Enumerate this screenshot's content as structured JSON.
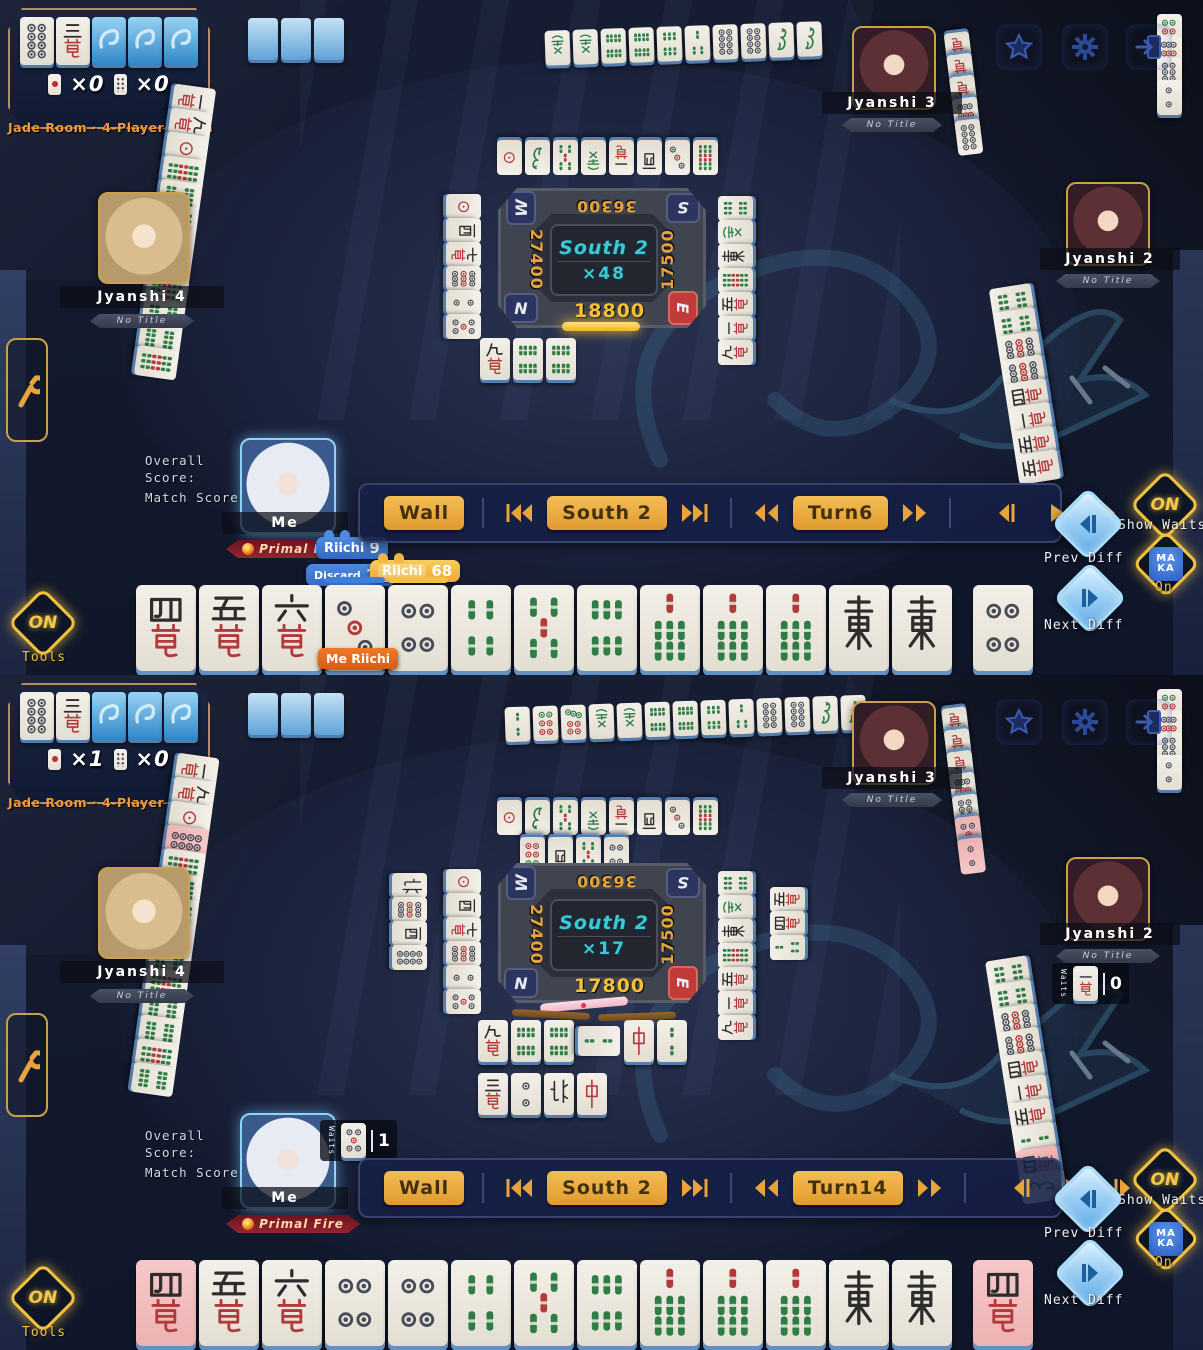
{
  "panels": [
    {
      "dora": {
        "tiles": [
          "8p",
          "3m",
          "back",
          "back",
          "back"
        ],
        "counter1_value": "×0",
        "counter2_value": "×0"
      },
      "room_label": "Jade Room · 4-Player South",
      "players": {
        "j3": {
          "name": "Jyanshi 3",
          "title": "No Title"
        },
        "j4": {
          "name": "Jyanshi 4",
          "title": "No Title"
        },
        "j2": {
          "name": "Jyanshi 2",
          "title": "No Title"
        },
        "me": {
          "name": "Me",
          "title": "Primal Fire"
        }
      },
      "me_panel": {
        "overall_label": "Overall Score:",
        "match_label": "Match Score:",
        "overall_grade": "S-",
        "match_grade": "S-",
        "grade_sub": "MAKA"
      },
      "center": {
        "seat_tl": "W",
        "seat_tr": "S",
        "seat_bl": "N",
        "seat_br": "E",
        "score_top": "36300",
        "score_left": "27400",
        "score_right": "17500",
        "score_bottom": "18800",
        "round": "South 2",
        "multiplier": "×48"
      },
      "replay": {
        "wall": "Wall",
        "round": "South 2",
        "turn": "Turn6"
      },
      "side": {
        "show_waits_state": "ON",
        "show_waits_label": "Show Waits",
        "prev_label": "Prev Diff",
        "next_label": "Next Diff",
        "maka_top": "MA",
        "maka_bottom": "KA",
        "maka_label": "On",
        "tools_state": "ON",
        "tools_label": "Tools"
      },
      "hints": {
        "riichi_label": "Riichi",
        "riichi_value": "9",
        "discard_label": "Discard",
        "discard_value": "14",
        "best_label": "Riichi",
        "best_value": "68",
        "me_riichi": "Me Riichi"
      },
      "hand": {
        "tiles": [
          "4m",
          "5m",
          "6m",
          "3p",
          "4p",
          "4s",
          "5s",
          "6s",
          "7s",
          "7s",
          "7s",
          "E",
          "E"
        ],
        "drawn": "4p"
      },
      "walls": {
        "top": [
          "back",
          "back",
          "back"
        ]
      },
      "rivers": {
        "j3_row": [
          "F",
          "F",
          "8s",
          "8s",
          "6s",
          "3s",
          "8p",
          "8p",
          "1s",
          "1s"
        ],
        "j3_col": [
          "7m",
          "7m",
          "6m",
          "9p",
          "8p"
        ],
        "j4_col": [
          "1m",
          "9m",
          "1p",
          "9s",
          "8s",
          "9s",
          "8s",
          "8s",
          "9s",
          "8s",
          "8s",
          "9s"
        ],
        "j2_row": [
          "6p",
          "9p",
          "8p",
          "2p"
        ],
        "j2_col": [
          "6s",
          "6s",
          "9p",
          "9p",
          "4m",
          "1m",
          "5m",
          "5m"
        ],
        "pond_top": [
          "1p",
          "1s",
          "5s",
          "F",
          "1m",
          "W",
          "3p",
          "9s"
        ],
        "pond_left": [
          "1p",
          "W",
          "7m",
          "9p",
          "2p",
          "5p"
        ],
        "pond_right": [
          "6s",
          "F",
          "E",
          "9s",
          "5m",
          "1m",
          "9m"
        ],
        "pond_me": [
          "9m",
          "8s",
          "8s"
        ]
      }
    },
    {
      "dora": {
        "tiles": [
          "8p",
          "3m",
          "back",
          "back",
          "back"
        ],
        "counter1_value": "×1",
        "counter2_value": "×0"
      },
      "room_label": "Jade Room · 4-Player South",
      "players": {
        "j3": {
          "name": "Jyanshi 3",
          "title": "No Title"
        },
        "j4": {
          "name": "Jyanshi 4",
          "title": "No Title"
        },
        "j2": {
          "name": "Jyanshi 2",
          "title": "No Title"
        },
        "me": {
          "name": "Me",
          "title": "Primal Fire"
        }
      },
      "me_panel": {
        "overall_label": "Overall Score:",
        "match_label": "Match Score:",
        "overall_grade": "S-",
        "match_grade": "S-",
        "grade_sub": "MAKA"
      },
      "center": {
        "seat_tl": "W",
        "seat_tr": "S",
        "seat_bl": "N",
        "seat_br": "E",
        "score_top": "36300",
        "score_left": "27400",
        "score_right": "17500",
        "score_bottom": "17800",
        "round": "South 2",
        "multiplier": "×17"
      },
      "replay": {
        "wall": "Wall",
        "round": "South 2",
        "turn": "Turn14"
      },
      "side": {
        "show_waits_state": "ON",
        "show_waits_label": "Show Waits",
        "prev_label": "Prev Diff",
        "next_label": "Next Diff",
        "maka_top": "MA",
        "maka_bottom": "KA",
        "maka_label": "On",
        "tools_state": "ON",
        "tools_label": "Tools"
      },
      "waits": {
        "me_label": "Waits",
        "me_tile": "5p",
        "me_count": "1",
        "j2_label": "Waits",
        "j2_tile": "1m",
        "j2_count": "0"
      },
      "hand": {
        "tiles": [
          "4m*",
          "5m",
          "6m",
          "4p",
          "4p",
          "4s",
          "5s",
          "6s",
          "7s",
          "7s",
          "7s",
          "E",
          "E"
        ],
        "drawn": "4m*"
      },
      "walls": {
        "top": [
          "back",
          "back",
          "back"
        ]
      },
      "rivers": {
        "j3_row": [
          "2s",
          "6p",
          "7p",
          "F",
          "F",
          "8s",
          "8s",
          "6s",
          "3s",
          "8p",
          "8p",
          "1s",
          "1s"
        ],
        "j3_col": [
          "7m",
          "7m",
          "6m",
          "9p",
          "8p",
          "5p*",
          "2p*"
        ],
        "j4_col": [
          "1m",
          "9m",
          "1p",
          "8p*",
          "9s",
          "8s",
          "9s",
          "8s",
          "8s",
          "9s",
          "8s",
          "8s",
          "9s",
          "8s"
        ],
        "j2_row": [
          "6p",
          "9p",
          "8p",
          "2p"
        ],
        "j2_col": [
          "6s",
          "6s",
          "9p",
          "9p",
          "4m",
          "1m",
          "5m",
          "2s",
          "4m*",
          "1s"
        ],
        "pond_top": [
          "1p",
          "1s",
          "5s",
          "F",
          "1m",
          "W",
          "3p",
          "9s"
        ],
        "pond_top2": [
          "6p",
          "W",
          "5s",
          "4p"
        ],
        "pond_left": [
          "1p",
          "W",
          "7m",
          "9p",
          "2p",
          "5p"
        ],
        "pond_left2": [
          "N",
          "9p",
          "W",
          "8p"
        ],
        "pond_right": [
          "6s",
          "F",
          "E",
          "9s",
          "5m",
          "1m",
          "9m"
        ],
        "pond_right2": [
          "5m",
          "4m",
          "3s"
        ],
        "pond_me": [
          "9m",
          "8s",
          "8s",
          "2s~",
          "C",
          "2s"
        ],
        "pond_me2": [
          "3m",
          "2p",
          "N",
          "C"
        ]
      }
    }
  ]
}
